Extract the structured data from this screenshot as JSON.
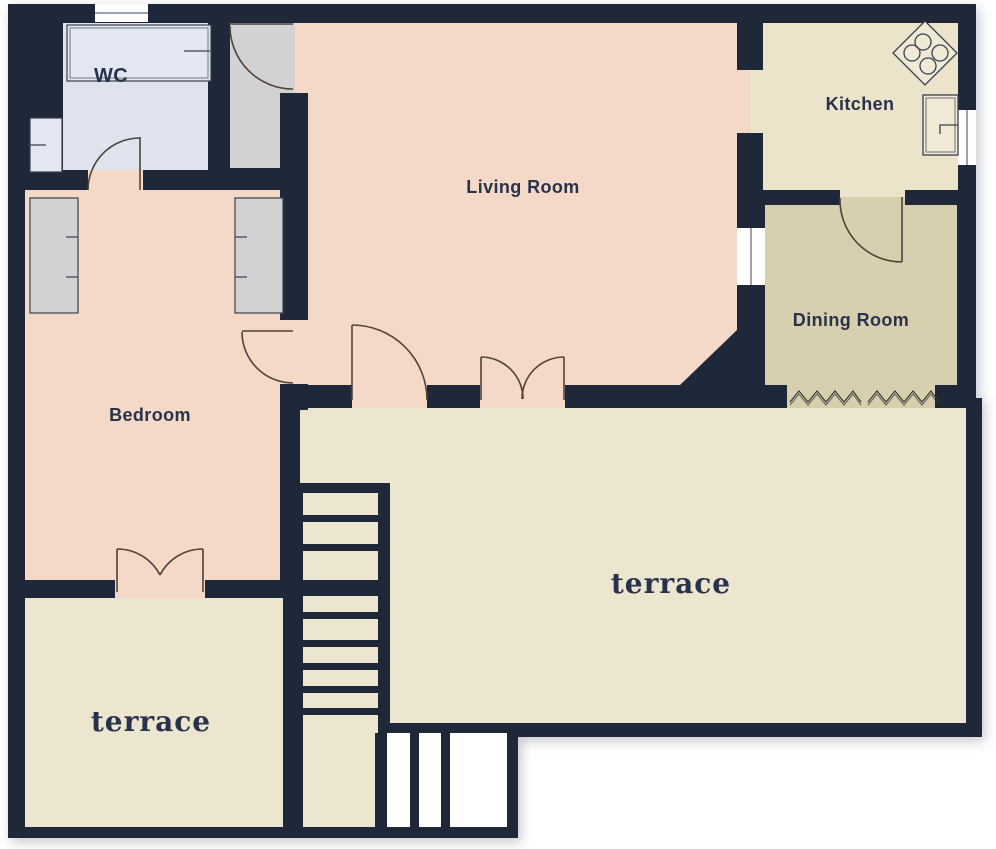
{
  "rooms": {
    "wc": {
      "label": "WC"
    },
    "living": {
      "label": "Living Room"
    },
    "kitchen": {
      "label": "Kitchen"
    },
    "dining": {
      "label": "Dining Room"
    },
    "bedroom": {
      "label": "Bedroom"
    },
    "terrace_left": {
      "label": "terrace"
    },
    "terrace_main": {
      "label": "terrace"
    }
  },
  "colors": {
    "wall": "#1e2838",
    "wc_floor": "#dee3ee",
    "living_floor": "#f4d9c8",
    "bedroom_floor": "#f4d9c8",
    "kitchen_floor": "#ebe3ca",
    "dining_floor": "#d8cfae",
    "terrace_floor": "#ece5d0",
    "closet_floor": "#d1d2d1",
    "window": "#ffffff",
    "window_divider": "#7c8290",
    "fixture": "#efe9d6",
    "wc_fixture": "#e3e7f1",
    "fixture_stroke": "#39404e",
    "door_stroke": "#4f4339",
    "zigzag": "#2f2f2f",
    "lower_flight": "#ffffff",
    "label": "#28324a"
  }
}
